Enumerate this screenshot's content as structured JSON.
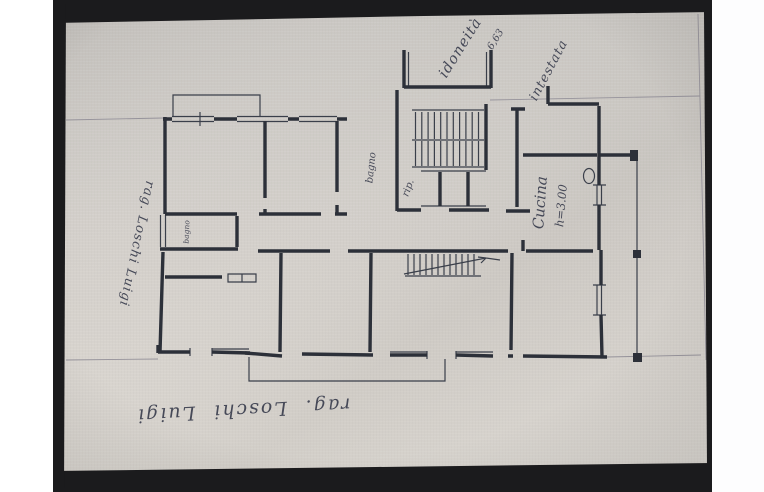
{
  "photo": {
    "description_labels": {
      "rooms": {
        "kitchen": "Cucina",
        "kitchen_height": "h=3.00",
        "bath": "bagno",
        "small_bath": "bagno",
        "storage": "rip."
      },
      "annotations": {
        "owner_bottom": "rag. Loschi Luigi",
        "owner_left": "rag. Loschi Luigi",
        "top_right_label": "intestata",
        "top_center_partial": "idoneità",
        "top_center_small": "6,63"
      }
    },
    "colors": {
      "margin": "#ffffff",
      "photo_border": "#1b1b1d",
      "paper_light": "#dbd7d1",
      "paper_dark": "#c9c6c2",
      "ink": "#2c3039",
      "ink_thin": "#3a3f4a",
      "pencil_faint": "#96939b"
    }
  }
}
